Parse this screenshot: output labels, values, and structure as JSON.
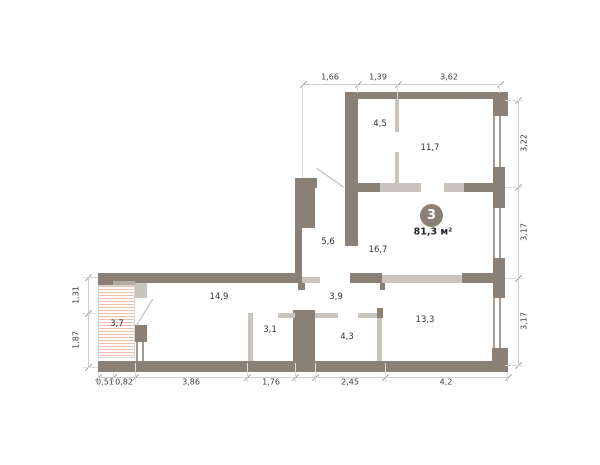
{
  "plan": {
    "badge": {
      "number": "3",
      "area": "81,3 м²"
    },
    "rooms": [
      {
        "name": "room-4-5",
        "label": "4,5"
      },
      {
        "name": "room-11-7",
        "label": "11,7"
      },
      {
        "name": "hall-5-6",
        "label": "5,6"
      },
      {
        "name": "living-16-7",
        "label": "16,7"
      },
      {
        "name": "room-14-9",
        "label": "14,9"
      },
      {
        "name": "balcony-3-7",
        "label": "3,7"
      },
      {
        "name": "room-3-1",
        "label": "3,1"
      },
      {
        "name": "corridor-3-9",
        "label": "3,9"
      },
      {
        "name": "bath-4-3",
        "label": "4,3"
      },
      {
        "name": "room-13-3",
        "label": "13,3"
      }
    ],
    "dimensions": {
      "top": [
        {
          "label": "1,66"
        },
        {
          "label": "1,39"
        },
        {
          "label": "3,62"
        }
      ],
      "right": [
        {
          "label": "3,22"
        },
        {
          "label": "3,17"
        },
        {
          "label": "3,17"
        }
      ],
      "bottom": [
        {
          "label": "0,51"
        },
        {
          "label": "0,82"
        },
        {
          "label": "3,86"
        },
        {
          "label": "1,76"
        },
        {
          "label": "2,45"
        },
        {
          "label": "4,2"
        }
      ],
      "left": [
        {
          "label": "1,31"
        },
        {
          "label": "1,87"
        }
      ]
    },
    "colors": {
      "wall": "#8a8076",
      "partition": "#c9c5be",
      "window_frame": "#a49c92",
      "balcony_hatch": "#f3bdb0",
      "dimension_text": "#3d3d3d"
    }
  }
}
